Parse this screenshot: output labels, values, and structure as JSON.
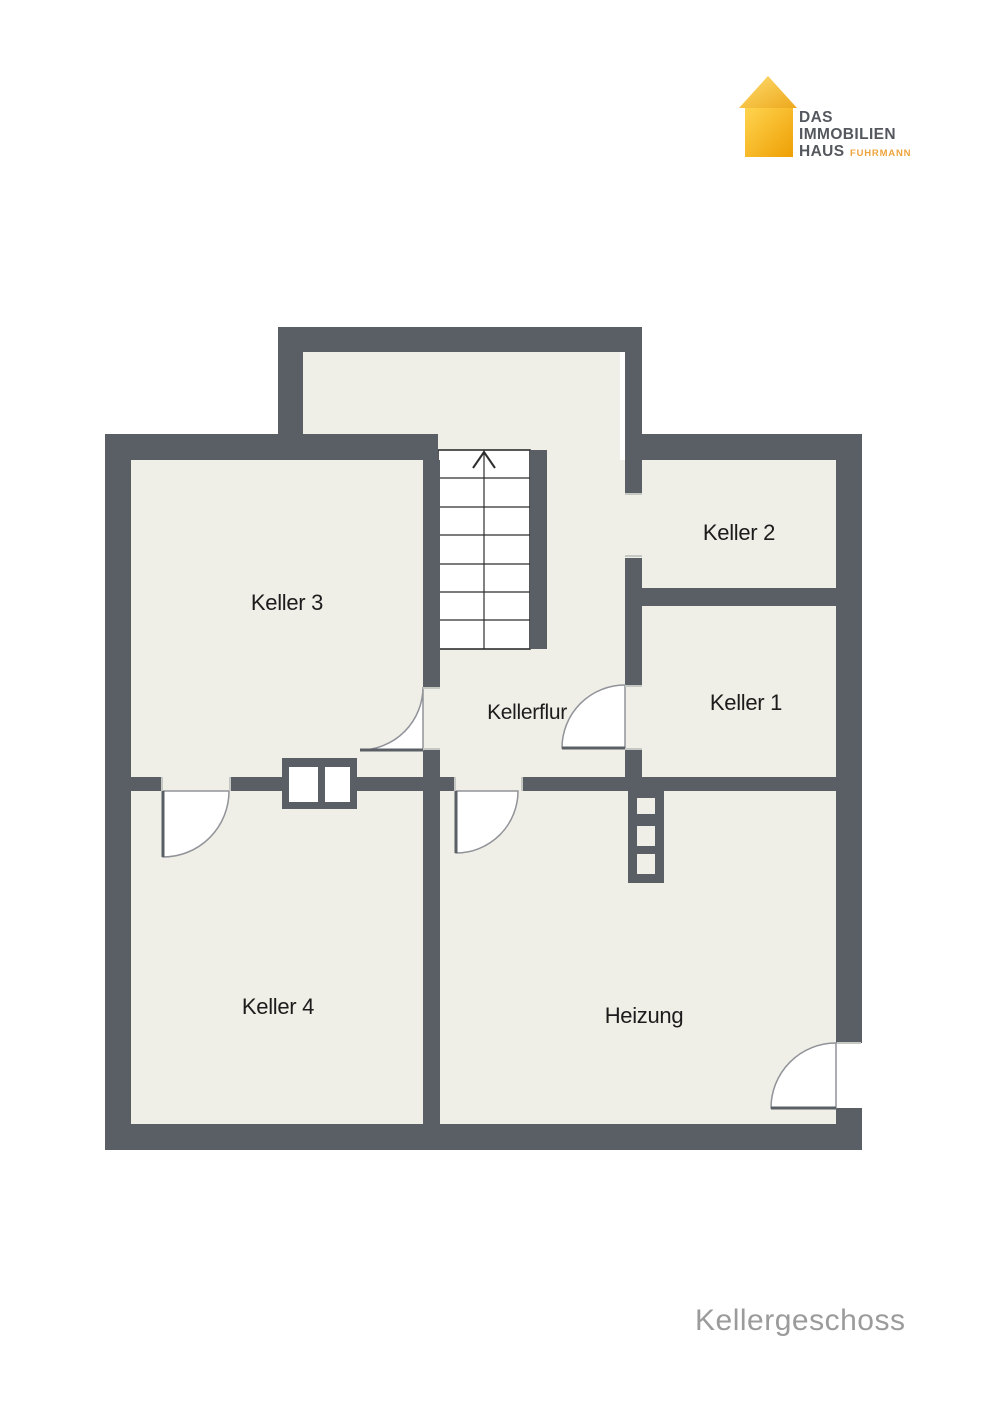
{
  "logo": {
    "line1": "DAS",
    "line2": "IMMOBILIEN",
    "line3": "HAUS",
    "sub": "FUHRMANN",
    "colors": {
      "house_gradient_top": "#ffd960",
      "house_gradient_bottom": "#efa305",
      "text": "#54585e",
      "sub_text": "#eda43d"
    }
  },
  "floorplan": {
    "title": "Kellergeschoss",
    "rooms": {
      "keller3": {
        "label": "Keller 3"
      },
      "keller2": {
        "label": "Keller 2"
      },
      "keller1": {
        "label": "Keller 1"
      },
      "kellerflur": {
        "label": "Kellerflur"
      },
      "keller4": {
        "label": "Keller 4"
      },
      "heizung": {
        "label": "Heizung"
      }
    },
    "icons": {
      "logo": "house-icon",
      "stairs": "arrow-up-icon"
    },
    "colors": {
      "wall": "#5a5f66",
      "floor": "#f0efe7",
      "door_swing": "#ffffff",
      "stair_outline": "#2e2e2e",
      "label": "#1c1c1c",
      "title": "#9b9b9b"
    }
  }
}
